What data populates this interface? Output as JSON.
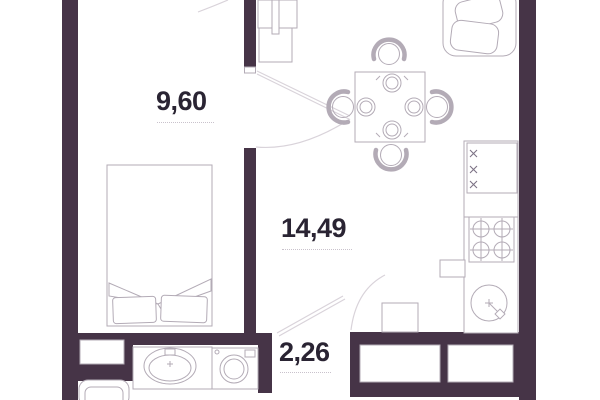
{
  "plan": {
    "title": "apartment-floor-plan",
    "rooms": [
      {
        "name": "bedroom",
        "area": "9,60"
      },
      {
        "name": "living-kitchen",
        "area": "14,49"
      },
      {
        "name": "hallway",
        "area": "2,26"
      }
    ],
    "colors": {
      "wall": "#463447",
      "line": "#b3abb6",
      "line_light": "#d9d3da",
      "text": "#2a2433",
      "underline": "#c9c2cc"
    }
  }
}
